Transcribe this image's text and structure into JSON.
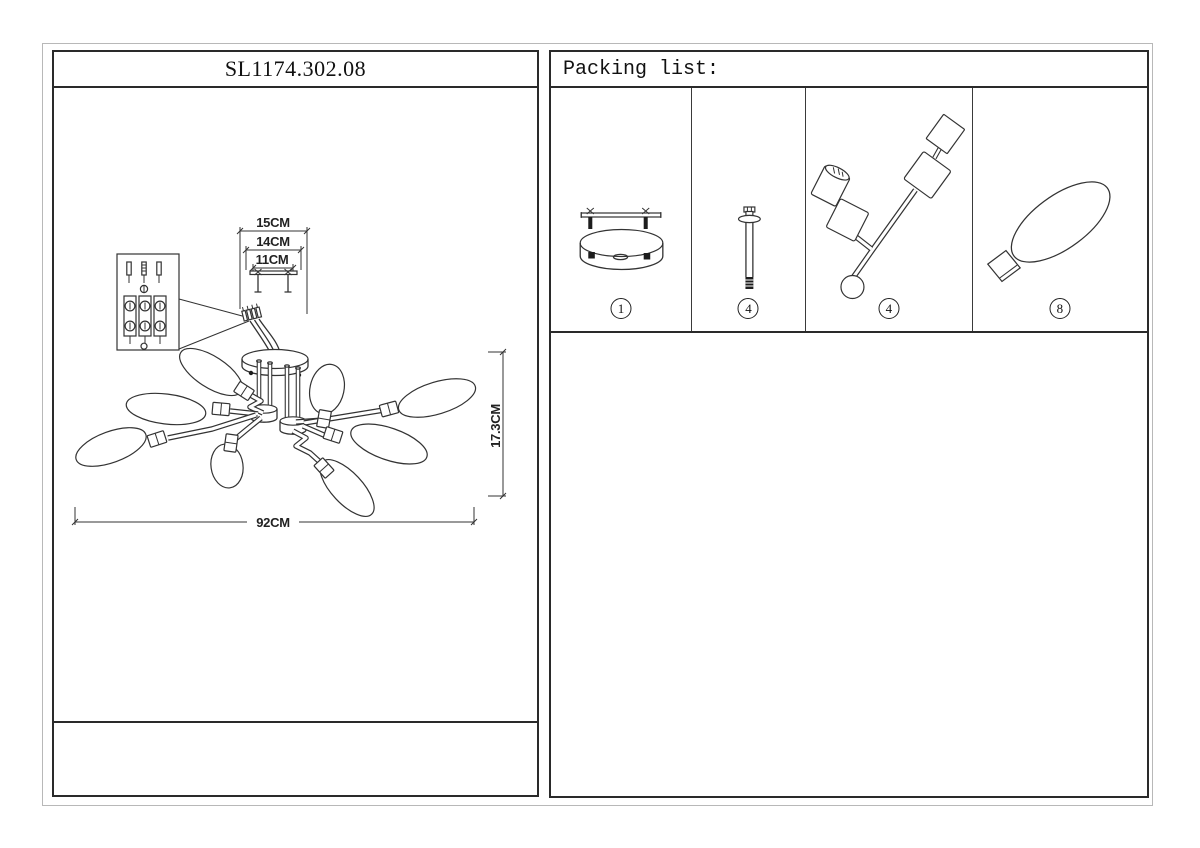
{
  "header": {
    "model_number": "SL1174.302.08"
  },
  "packing": {
    "title": "Packing list:",
    "items": [
      {
        "icon": "ceiling-mount-plate-icon",
        "qty": "1"
      },
      {
        "icon": "mounting-screw-icon",
        "qty": "4"
      },
      {
        "icon": "swivel-arm-icon",
        "qty": "4"
      },
      {
        "icon": "bulb-icon",
        "qty": "8"
      }
    ]
  },
  "diagram": {
    "dim_bracket_outer": "15CM",
    "dim_bracket_mid": "14CM",
    "dim_bracket_inner": "11CM",
    "dim_fixture_width": "92CM",
    "dim_fixture_height": "17.3CM"
  },
  "colors": {
    "line_art": "#333333",
    "panel_border": "#2a2a2a",
    "outer_frame": "#b8b8b8"
  }
}
